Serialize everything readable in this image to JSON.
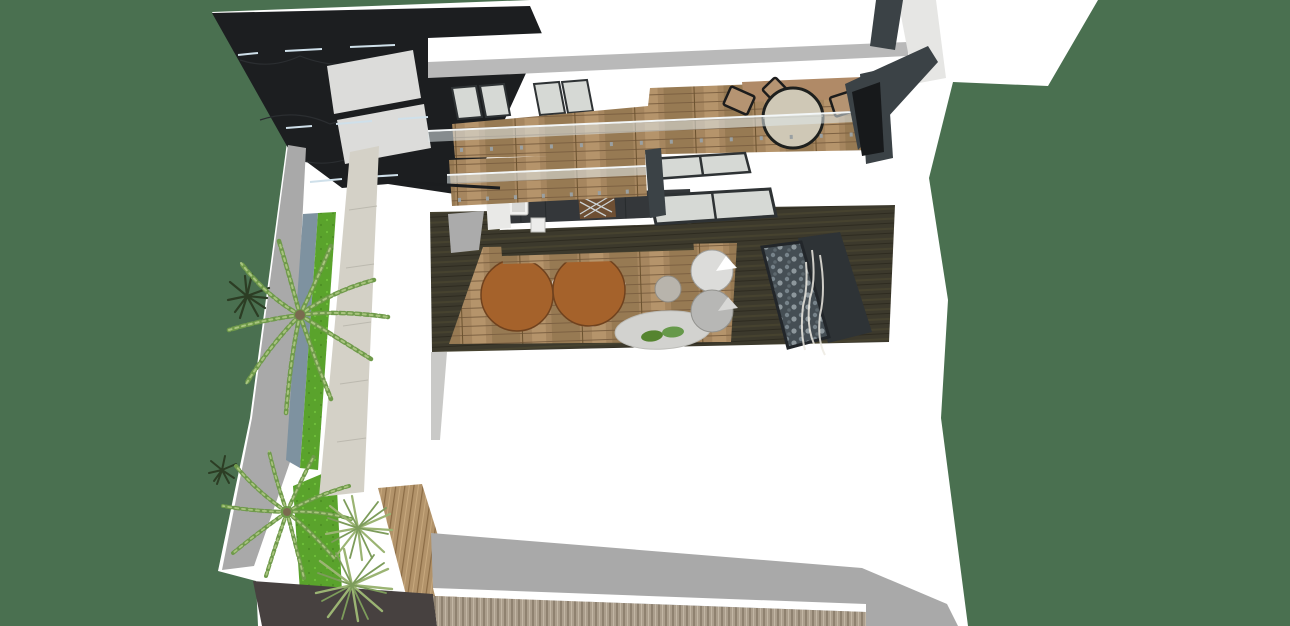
{
  "canvas": {
    "width": 1290,
    "height": 626
  },
  "scene": {
    "type": "3d-architectural-model-render",
    "view": "aerial-oblique-top-down",
    "subject": "modern two-story house with courtyard, terraces and flat roof"
  },
  "objects": [
    "dark-stone-roof-panel",
    "skylights",
    "concrete-feature-wall",
    "courtyard-walkway",
    "water-channel",
    "grass-strips",
    "palm-trees",
    "yucca-plants",
    "pine-shrubs",
    "upper-terrace-wood-deck",
    "glass-railings",
    "terrace-round-table",
    "terrace-chairs",
    "clerestory-windows",
    "kitchen-counter",
    "kitchen-sink",
    "wine-rack",
    "dishwasher",
    "dining-tables",
    "dining-chairs",
    "area-rug",
    "floor-cushions",
    "egg-chairs",
    "pebble-water-feature",
    "grass-plumes",
    "side-table",
    "flat-white-roof",
    "roof-fascia",
    "driveway",
    "slat-fence",
    "steel-beams",
    "wood-deck-patch"
  ],
  "colors": {
    "background": "#4a7050",
    "wall_white": "#ffffff",
    "wall_shadow": "#e6e6e4",
    "roof_gray": "#b9b9b9",
    "fascia_gray": "#a9a9a9",
    "stone_black": "#1c1e20",
    "steel_dark": "#3b4246",
    "near_black": "#17191b",
    "skylight": "#dcdcda",
    "glass": "#d6d9d5",
    "window_frame": "#2e3234",
    "rail_glass": "#dfe7ea",
    "rail_steel": "#f2f6f7",
    "wood_floor": "#a6865f",
    "deck_wood": "#b2936a",
    "floor_dark": "#3c392c",
    "counter_dark": "#34373a",
    "sink_white": "#f2f2f0",
    "wine_rack": "#6e4f33",
    "pebbles_dark": "#454e54",
    "plume_white": "#eceae2",
    "concrete": "#d4d1c7",
    "walkway_gray": "#a9a9a9",
    "water_channel": "#7e92a0",
    "grass": "#5aa32c",
    "palm_green": "#6f9a4a",
    "palm_light": "#a8c47e",
    "pine_dark": "#2c3d24",
    "yucca_green": "#9bb473",
    "table_brown": "#a5622b",
    "chair_black": "#1d1d1d",
    "chair_tan": "#b59472",
    "table_top_beige": "#cfc8b6",
    "rug_gray": "#d2d2cf",
    "cushion_green": "#55842f",
    "egg_chair_light": "#dcdcda",
    "egg_chair_gray": "#b7b7b5",
    "side_table": "#b8b4ac",
    "driveway": "#474140",
    "fence_tan": "#ab9e8c",
    "floor_tan": "#b08a67",
    "dash_blue": "#cfe0ea"
  }
}
